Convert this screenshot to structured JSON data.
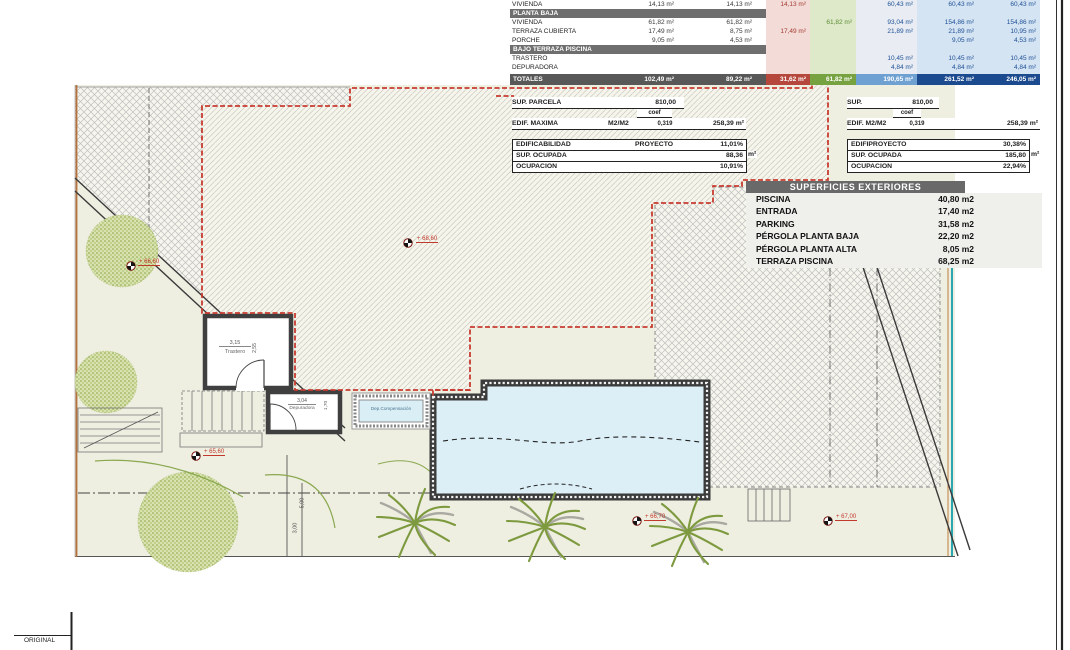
{
  "areas_table": {
    "rows": [
      {
        "label": "VIVIENDA",
        "v1": "14,13 m²",
        "v2": "14,13 m²",
        "pink": "14,13 m²",
        "green": "",
        "b1": "60,43 m²",
        "b2": "60,43 m²",
        "b3": "60,43 m²"
      },
      {
        "label": "PLANTA BAJA"
      },
      {
        "label": "VIVIENDA",
        "v1": "61,82 m²",
        "v2": "61,82 m²",
        "pink": "",
        "green": "61,82 m²",
        "b1": "93,04 m²",
        "b2": "154,86 m²",
        "b3": "154,86 m²"
      },
      {
        "label": "TERRAZA CUBIERTA",
        "v1": "17,49 m²",
        "v2": "8,75 m²",
        "pink": "17,49 m²",
        "green": "",
        "b1": "21,89 m²",
        "b2": "21,89 m²",
        "b3": "10,95 m²"
      },
      {
        "label": "PORCHE",
        "v1": "9,05 m²",
        "v2": "4,53 m²",
        "pink": "",
        "green": "",
        "b1": "",
        "b2": "9,05 m²",
        "b3": "4,53 m²"
      },
      {
        "label": "BAJO TERRAZA PISCINA"
      },
      {
        "label": "TRASTERO",
        "v1": "",
        "v2": "",
        "pink": "",
        "green": "",
        "b1": "10,45 m²",
        "b2": "10,45 m²",
        "b3": "10,45 m²"
      },
      {
        "label": "DEPURADORA",
        "v1": "",
        "v2": "",
        "pink": "",
        "green": "",
        "b1": "4,84 m²",
        "b2": "4,84 m²",
        "b3": "4,84 m²"
      },
      {
        "label": "TOTALES",
        "v1": "102,49 m²",
        "v2": "89,22 m²",
        "pink": "31,62 m²",
        "green": "61,82 m²",
        "b1": "190,65 m²",
        "b2": "261,52 m²",
        "b3": "246,05 m²"
      }
    ]
  },
  "params_left": {
    "parcela_label": "SUP. PARCELA",
    "parcela_value": "810,00",
    "coef_label": "coef",
    "edif_label": "EDIF. MAXIMA",
    "edif_unit": "M2/M2",
    "coef_value": "0,319",
    "edif_value": "258,39 m²",
    "rows": [
      {
        "label": "EDIFICABILIDAD",
        "mid": "PROYECTO",
        "value": "11,01%"
      },
      {
        "label": "SUP. OCUPADA",
        "mid": "",
        "value": "88,36"
      },
      {
        "label": "OCUPACION",
        "mid": "",
        "value": "10,91%"
      }
    ],
    "ocupada_suffix": "m²"
  },
  "params_right": {
    "parcela_label": "SUP.",
    "parcela_value": "810,00",
    "coef_label": "coef",
    "edif_label": "EDIF. M2/M2",
    "coef_value": "0,319",
    "edif_value": "258,39 m²",
    "rows": [
      {
        "label": "EDIFIPROYECTO",
        "value": "30,38%"
      },
      {
        "label": "SUP. OCUPADA",
        "value": "185,80"
      },
      {
        "label": "OCUPACION",
        "value": "22,94%"
      }
    ],
    "ocupada_suffix": "m²"
  },
  "exteriores": {
    "title": "SUPERFICIES EXTERIORES",
    "rows": [
      {
        "label": "PISCINA",
        "value": "40,80 m2"
      },
      {
        "label": "ENTRADA",
        "value": "17,40 m2"
      },
      {
        "label": "PARKING",
        "value": "31,58 m2"
      },
      {
        "label": "PÉRGOLA PLANTA BAJA",
        "value": "22,20 m2"
      },
      {
        "label": "PÉRGOLA PLANTA ALTA",
        "value": "8,05 m2"
      },
      {
        "label": "TERRAZA PISCINA",
        "value": "68,25 m2"
      }
    ]
  },
  "plan": {
    "trastero_dim": "3,15",
    "trastero_label": "Trastero",
    "trastero_side": "2,55",
    "depuradora_dim": "3,04",
    "depuradora_label": "Depuradora",
    "depuradora_side": "1,70",
    "dep_comp_label": "Dep.Compensación",
    "dim_5": "5,00",
    "dim_3": "3,00",
    "levels": {
      "m1": "+ 68,60",
      "m2": "+ 65,60",
      "m3": "+ 66,70",
      "m4": "+ 67,00",
      "m5": "+ 66,60"
    }
  },
  "footer": {
    "original": "ORIGINAL"
  }
}
